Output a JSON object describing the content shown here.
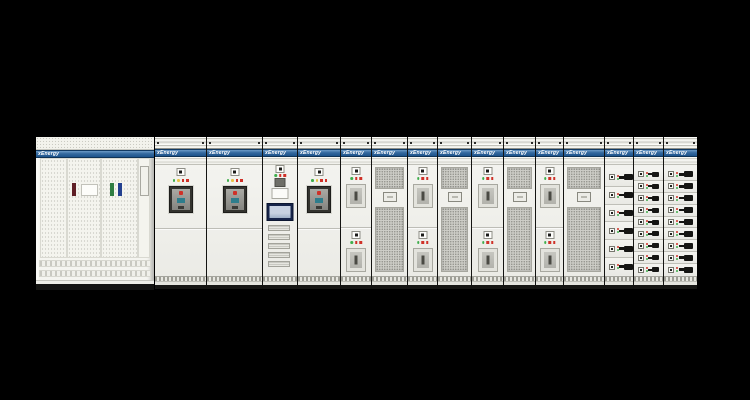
{
  "scene": {
    "description": "Product photograph of a low-voltage switchgear and motor control center lineup on a black studio background",
    "background": "#000000"
  },
  "brand": {
    "label_text": "xEnergy",
    "label_color": "#ffffff"
  },
  "palette": {
    "body": "#f0f0ec",
    "stripe-top": "#6d9bc7",
    "stripe-bottom": "#1c528b",
    "mesh": "#cdcdc7",
    "dark-frame": "#33332f",
    "handle-black": "#151513",
    "screen-navy": "#16244a",
    "green": "#3fae4c",
    "amber": "#e9c243",
    "red": "#cf3128",
    "teal": "#2e7d8c"
  },
  "left_cabinet": {
    "type": "perforated-door distribution cabinet",
    "door_count": 3,
    "stickers": [
      {
        "name": "red-handle-bar",
        "color": "#5f1f26",
        "left": 36
      },
      {
        "name": "green-handle-bar",
        "color": "#2f7d42",
        "left": 74
      },
      {
        "name": "blue-handle-bar",
        "color": "#23408f",
        "left": 82
      }
    ]
  },
  "lineup": {
    "acb_lights": [
      "green",
      "amber",
      "red",
      "red"
    ],
    "switch_lights": [
      "green",
      "red",
      "red"
    ],
    "drawer_dots": [
      "red",
      "green"
    ],
    "sections": [
      {
        "id": "incomer-acb-1",
        "type": "acb",
        "width": 51
      },
      {
        "id": "incomer-acb-2",
        "type": "acb",
        "width": 56
      },
      {
        "id": "control-hmi",
        "type": "hmi",
        "width": 35,
        "combs": 5
      },
      {
        "id": "feeder-acb-3",
        "type": "acb",
        "width": 43
      },
      {
        "id": "switch-feeder-1",
        "type": "switch2",
        "width": 31
      },
      {
        "id": "vent-panel-1",
        "type": "mesh",
        "width": 36
      },
      {
        "id": "switch-feeder-2",
        "type": "switch2",
        "width": 30
      },
      {
        "id": "vent-panel-2",
        "type": "mesh",
        "width": 34
      },
      {
        "id": "switch-feeder-3",
        "type": "switch2",
        "width": 32
      },
      {
        "id": "vent-panel-3",
        "type": "mesh",
        "width": 32
      },
      {
        "id": "switch-feeder-4",
        "type": "switch2",
        "width": 28
      },
      {
        "id": "vent-panel-4",
        "type": "mesh",
        "width": 41
      },
      {
        "id": "mcc-drawers-large",
        "type": "drawers",
        "width": 29,
        "rows": 6,
        "handle": "large"
      },
      {
        "id": "mcc-drawers-1",
        "type": "drawers",
        "width": 30,
        "rows": 9,
        "handle": "small"
      },
      {
        "id": "mcc-drawers-2",
        "type": "drawers",
        "width": 34,
        "rows": 9,
        "handle": "large"
      }
    ]
  }
}
